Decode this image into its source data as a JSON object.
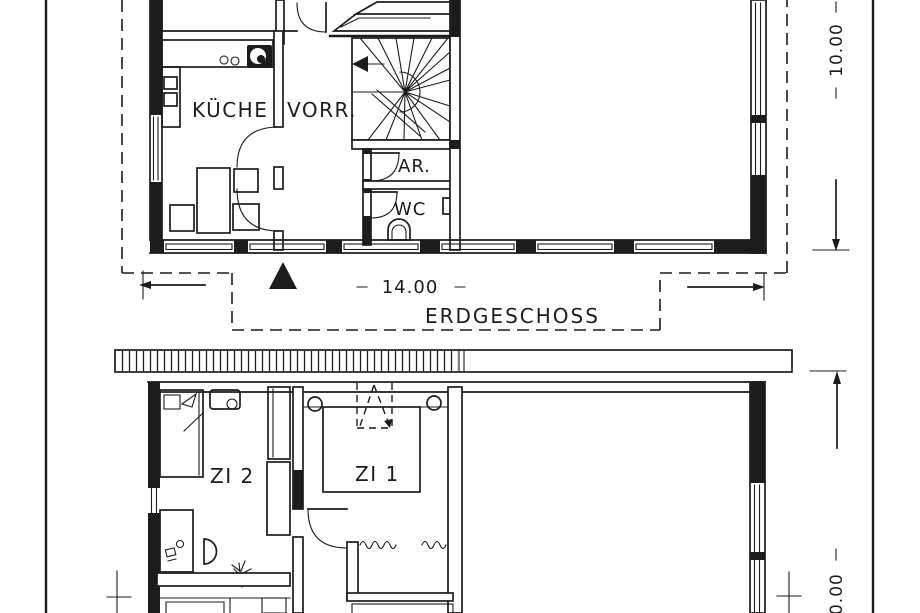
{
  "colors": {
    "ink": "#1c1c1c",
    "paper": "#ffffff"
  },
  "ground_floor": {
    "floor_label": "ERDGESCHOSS",
    "room_kitchen": "KÜCHE",
    "room_pantry": "VORR.",
    "room_storage": "AR.",
    "room_wc": "WC",
    "dim_width": "14.00",
    "dim_depth": "10.00"
  },
  "upper_floor": {
    "room_zi2": "ZI 2",
    "room_zi1": "ZI 1",
    "dim_depth": "10.00"
  }
}
